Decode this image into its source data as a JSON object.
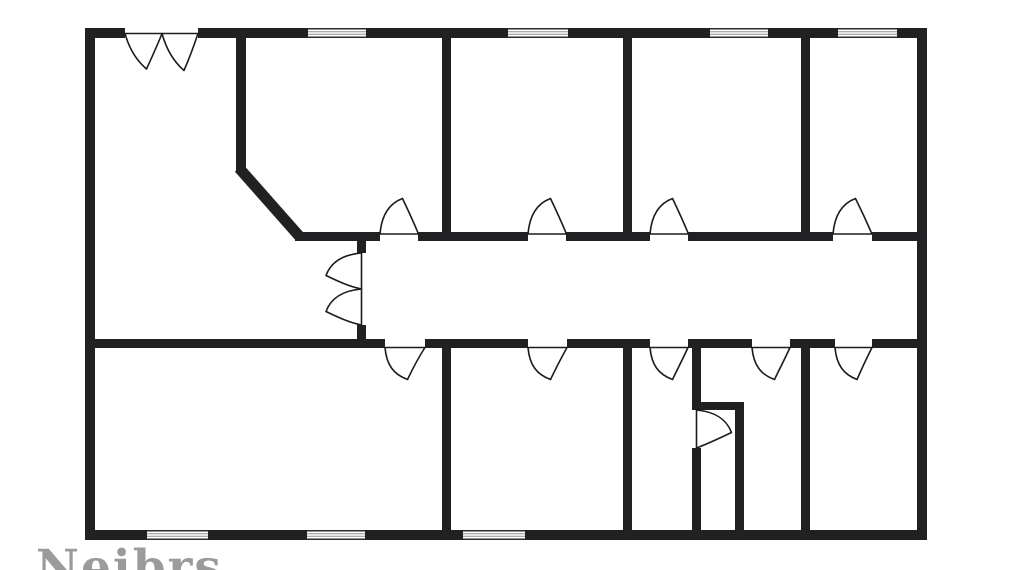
{
  "canvas": {
    "width": 1011,
    "height": 570,
    "background": "#ffffff"
  },
  "watermark": {
    "text": "Neibrs",
    "color": "#9b9b9b"
  },
  "floorplan": {
    "wall_color": "#212123",
    "door_stroke": "#1c1c1e",
    "door_fill": "#ffffff",
    "window_frame_color": "#2b2b2d",
    "window_pane_color": "#8f8f8f",
    "walls": [
      {
        "name": "outer-wall-top",
        "x": 85,
        "y": 28,
        "w": 40,
        "h": 10
      },
      {
        "name": "outer-wall-top",
        "x": 198,
        "y": 28,
        "w": 110,
        "h": 10
      },
      {
        "name": "outer-wall-top",
        "x": 366,
        "y": 28,
        "w": 142,
        "h": 10
      },
      {
        "name": "outer-wall-top",
        "x": 568,
        "y": 28,
        "w": 142,
        "h": 10
      },
      {
        "name": "outer-wall-top",
        "x": 768,
        "y": 28,
        "w": 70,
        "h": 10
      },
      {
        "name": "outer-wall-top",
        "x": 897,
        "y": 28,
        "w": 30,
        "h": 10
      },
      {
        "name": "outer-wall-left",
        "x": 85,
        "y": 28,
        "w": 10,
        "h": 512
      },
      {
        "name": "outer-wall-right",
        "x": 917,
        "y": 28,
        "w": 10,
        "h": 512
      },
      {
        "name": "outer-wall-bottom",
        "x": 85,
        "y": 530,
        "w": 62,
        "h": 10
      },
      {
        "name": "outer-wall-bottom",
        "x": 208,
        "y": 530,
        "w": 99,
        "h": 10
      },
      {
        "name": "outer-wall-bottom",
        "x": 365,
        "y": 530,
        "w": 98,
        "h": 10
      },
      {
        "name": "outer-wall-bottom",
        "x": 525,
        "y": 530,
        "w": 402,
        "h": 10
      },
      {
        "name": "wall-top-left-room",
        "x": 236,
        "y": 38,
        "w": 10,
        "h": 134
      },
      {
        "name": "corridor-wall-top",
        "x": 295,
        "y": 232,
        "w": 85,
        "h": 9
      },
      {
        "name": "corridor-wall-top",
        "x": 418,
        "y": 232,
        "w": 110,
        "h": 9
      },
      {
        "name": "corridor-wall-top",
        "x": 566,
        "y": 232,
        "w": 84,
        "h": 9
      },
      {
        "name": "corridor-wall-top",
        "x": 688,
        "y": 232,
        "w": 145,
        "h": 9
      },
      {
        "name": "corridor-wall-top",
        "x": 872,
        "y": 232,
        "w": 45,
        "h": 9
      },
      {
        "name": "corridor-wall-bottom",
        "x": 85,
        "y": 339,
        "w": 300,
        "h": 9
      },
      {
        "name": "corridor-wall-bottom",
        "x": 425,
        "y": 339,
        "w": 103,
        "h": 9
      },
      {
        "name": "corridor-wall-bottom",
        "x": 567,
        "y": 339,
        "w": 83,
        "h": 9
      },
      {
        "name": "corridor-wall-bottom",
        "x": 688,
        "y": 339,
        "w": 64,
        "h": 9
      },
      {
        "name": "corridor-wall-bottom",
        "x": 790,
        "y": 339,
        "w": 45,
        "h": 9
      },
      {
        "name": "corridor-wall-bottom",
        "x": 872,
        "y": 339,
        "w": 45,
        "h": 9
      },
      {
        "name": "corridor-end-stub-top",
        "x": 357,
        "y": 241,
        "w": 9,
        "h": 12
      },
      {
        "name": "corridor-end-stub-bottom",
        "x": 357,
        "y": 325,
        "w": 9,
        "h": 14
      },
      {
        "name": "wall-room-divider-top",
        "x": 442,
        "y": 38,
        "w": 9,
        "h": 203
      },
      {
        "name": "wall-room-divider-top",
        "x": 623,
        "y": 38,
        "w": 9,
        "h": 203
      },
      {
        "name": "wall-room-divider-top",
        "x": 801,
        "y": 38,
        "w": 9,
        "h": 203
      },
      {
        "name": "wall-room-divider-bottom",
        "x": 442,
        "y": 348,
        "w": 9,
        "h": 182
      },
      {
        "name": "wall-room-divider-bottom",
        "x": 623,
        "y": 348,
        "w": 9,
        "h": 182
      },
      {
        "name": "wall-room-divider-bottom",
        "x": 801,
        "y": 348,
        "w": 9,
        "h": 182
      },
      {
        "name": "closet-wall-left-upper",
        "x": 692,
        "y": 348,
        "w": 9,
        "h": 62
      },
      {
        "name": "closet-wall-left-lower",
        "x": 692,
        "y": 448,
        "w": 9,
        "h": 82
      },
      {
        "name": "closet-wall-top",
        "x": 692,
        "y": 402,
        "w": 52,
        "h": 8
      },
      {
        "name": "closet-wall-right",
        "x": 735,
        "y": 402,
        "w": 9,
        "h": 128
      }
    ],
    "diagonal_walls": [
      {
        "name": "wall-diagonal",
        "x1": 239,
        "y1": 168,
        "x2": 300,
        "y2": 237,
        "width": 11
      }
    ],
    "windows": [
      {
        "name": "window-top-1",
        "x": 308,
        "y": 28,
        "w": 58,
        "h": 10
      },
      {
        "name": "window-top-2",
        "x": 508,
        "y": 28,
        "w": 60,
        "h": 10
      },
      {
        "name": "window-top-3",
        "x": 710,
        "y": 28,
        "w": 58,
        "h": 10
      },
      {
        "name": "window-top-4",
        "x": 838,
        "y": 28,
        "w": 59,
        "h": 10
      },
      {
        "name": "window-bottom-1",
        "x": 147,
        "y": 530,
        "w": 61,
        "h": 10
      },
      {
        "name": "window-bottom-2",
        "x": 307,
        "y": 530,
        "w": 58,
        "h": 10
      },
      {
        "name": "window-bottom-3",
        "x": 463,
        "y": 530,
        "w": 62,
        "h": 10
      }
    ],
    "doors": [
      {
        "name": "entry-door-left-leaf",
        "d": "M125,33.5 C129,48 136,60 146.5,69 C152,57 157.5,45 162,33.5 Z"
      },
      {
        "name": "entry-door-right-leaf",
        "d": "M162,33.5 C166,48 173,61 184,70.5 C189.5,58 194,45.5 198,33.5 Z"
      },
      {
        "name": "hall-double-door-upper-leaf",
        "d": "M361.5,253 C343.5,254.5 331,262 326,275.5 C337.5,281 349,286.5 361.5,289 Z"
      },
      {
        "name": "hall-double-door-lower-leaf",
        "d": "M361.5,289 C343.5,290.5 331,298 326,311.5 C337.5,317 349,322.5 361.5,325 Z"
      },
      {
        "name": "door-room-top-1",
        "d": "M380,234 C381.5,216 389,203.5 402.5,198.5 C408,210 413.5,222 418.5,234 Z"
      },
      {
        "name": "door-room-top-2",
        "d": "M528,234 C529.5,216 537,203.5 550.5,198.5 C556,210 561.5,222 566.5,234 Z"
      },
      {
        "name": "door-room-top-3",
        "d": "M650,234 C651.5,216 659,203.5 672.5,198.5 C678,210 683.5,222 688.5,234 Z"
      },
      {
        "name": "door-room-top-4",
        "d": "M833,234 C834.5,216 842,203.5 855.5,198.5 C861.2,210 866.8,222 872,234 Z"
      },
      {
        "name": "door-room-bottom-1",
        "d": "M385,347.5 C386.5,365.5 394,374.5 407.5,379.5 C413,368 418.5,357.5 425,347.5 Z"
      },
      {
        "name": "door-room-bottom-2",
        "d": "M528,347.5 C529.5,365.5 537,374.5 550.5,379.5 C556,368 561.5,357.5 567,347.5 Z"
      },
      {
        "name": "door-room-bottom-3",
        "d": "M650,347.5 C651.5,365.5 659,374.5 672.5,379.5 C678,368 683.5,357.5 688,347.5 Z"
      },
      {
        "name": "door-room-bottom-4",
        "d": "M752,347.5 C753.5,365.5 761,374.5 774.5,379.5 C780,368 785.5,357.5 790,347.5 Z"
      },
      {
        "name": "door-room-bottom-5",
        "d": "M835,347.5 C836.5,365.5 844,374.5 857,379.5 C862,368 867,357.5 872,347.5 Z"
      },
      {
        "name": "closet-door",
        "d": "M696.5,410 C714,411.5 726.5,419 731.5,432.5 C720,438 708.5,443.5 696.5,448 Z"
      }
    ]
  }
}
